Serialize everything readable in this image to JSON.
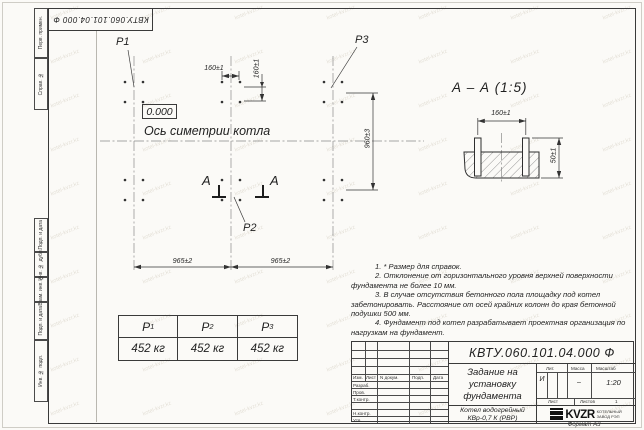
{
  "stamp_top": "КВТУ.060.101.04.000  Ф",
  "watermark": {
    "text": "kotel-kvzr.kz"
  },
  "margin_labels": {
    "top": [
      "Перв. примен.",
      "Справ. №"
    ],
    "bottom": [
      "Подп. и дата",
      "Инв. № дубл.",
      "Взам. инв. №",
      "Подп. и дата",
      "Инв. № подл."
    ]
  },
  "plan": {
    "p1": "P1",
    "p2": "P2",
    "p3": "P3",
    "elevation": "0.000",
    "axis_label": "Ось симетрии котла",
    "section_letter_left": "А",
    "section_letter_right": "А",
    "dim_160h": "160±1",
    "dim_160v": "160±1",
    "dim_965_left": "965±2",
    "dim_965_right": "965±2",
    "dim_960": "960±3"
  },
  "section": {
    "title": "А – А (1:5)",
    "dim_160": "160±1",
    "dim_50": "50±1"
  },
  "loads_table": {
    "headers": [
      {
        "base": "P",
        "sub": "1"
      },
      {
        "base": "P",
        "sub": "2"
      },
      {
        "base": "P",
        "sub": "3"
      }
    ],
    "values": [
      "452 кг",
      "452 кг",
      "452 кг"
    ]
  },
  "notes": [
    "1. * Размер для справок.",
    "2. Отклонение от горизонтального уровня верхней поверхности фундамента не более 10 мм.",
    "3. В случае отсутствия бетонного пола площадку под котел забетонировать. Расстояние от осей крайних колонн до края бетонной подушки 500 мм.",
    "4. Фундамент под котел разрабатывает проектная организация по нагрузкам на фундамент."
  ],
  "title_block": {
    "number": "КВТУ.060.101.04.000  Ф",
    "title_lines": [
      "Задание на",
      "установку",
      "фундамента"
    ],
    "product_lines": [
      "Котел водогрейный",
      "КВр-0,7 К (РВР)"
    ],
    "change_header": [
      "Изм.",
      "Лист",
      "N докум.",
      "Подп.",
      "Дата"
    ],
    "row_labels": [
      "Разраб.",
      "Пров.",
      "Т.контр.",
      "",
      "Н.контр.",
      "Утв."
    ],
    "lit_header": [
      "Лит.",
      "Масса",
      "Масштаб"
    ],
    "lit_value": "И",
    "mass_value": "–",
    "scale_value": "1:20",
    "sheet_label": "Лист",
    "sheets_label": "Листов",
    "sheets_value": "1",
    "logo_text": "KVZR",
    "logo_caption": [
      "КОТЕЛЬНЫЙ",
      "ЗАВОД РЭП"
    ],
    "format_label": "Формат А3"
  }
}
